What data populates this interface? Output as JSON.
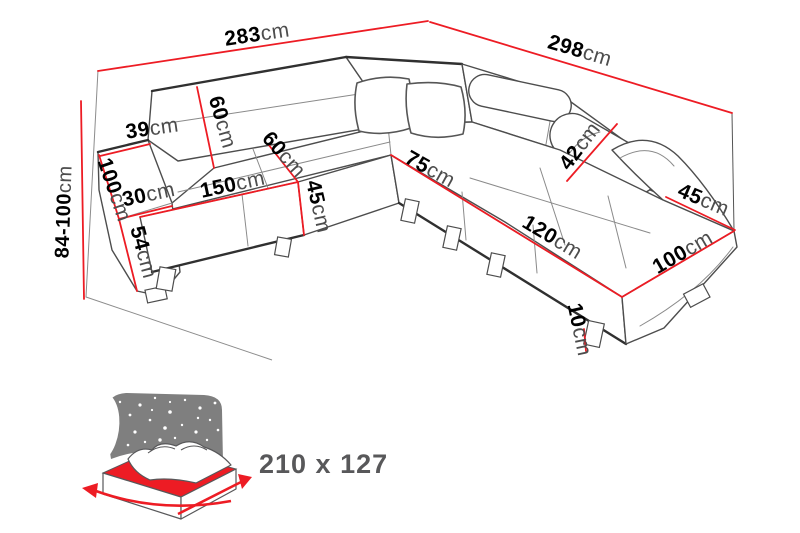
{
  "image": {
    "width": 800,
    "height": 533,
    "background": "#ffffff",
    "description": "Corner sofa technical dimension diagram with sleeping-function bed icon"
  },
  "colors": {
    "dimension_line_red": "#ed1c24",
    "dimension_number": "#000000",
    "dimension_unit": "#4d4d4d",
    "sofa_outline_gray": "#4d4d4d",
    "bed_headboard_gray": "#7f7f7f",
    "bed_mattress_red": "#ed1c24",
    "bed_size_text": "#58585a"
  },
  "dimensions": {
    "back_width_left": {
      "value": "283",
      "unit": "cm"
    },
    "back_width_right": {
      "value": "298",
      "unit": "cm"
    },
    "overall_height": {
      "value": "84-100",
      "unit": "cm"
    },
    "armrest_left_top_width": {
      "value": "39",
      "unit": "cm"
    },
    "backrest_height": {
      "value": "60",
      "unit": "cm"
    },
    "armrest_left_length": {
      "value": "100",
      "unit": "cm"
    },
    "armrest_left_front": {
      "value": "30",
      "unit": "cm"
    },
    "armrest_left_height": {
      "value": "54",
      "unit": "cm"
    },
    "seat_length_left": {
      "value": "150",
      "unit": "cm"
    },
    "seat_depth": {
      "value": "60",
      "unit": "cm"
    },
    "seat_height": {
      "value": "45",
      "unit": "cm"
    },
    "corner_section_width": {
      "value": "75",
      "unit": "cm"
    },
    "headrest_height": {
      "value": "42",
      "unit": "cm"
    },
    "armrest_right_width": {
      "value": "45",
      "unit": "cm"
    },
    "chaise_length": {
      "value": "120",
      "unit": "cm"
    },
    "chaise_width": {
      "value": "100",
      "unit": "cm"
    },
    "leg_height": {
      "value": "10",
      "unit": "cm"
    }
  },
  "sleeping_function": {
    "bed_size_label": "210 x 127"
  }
}
